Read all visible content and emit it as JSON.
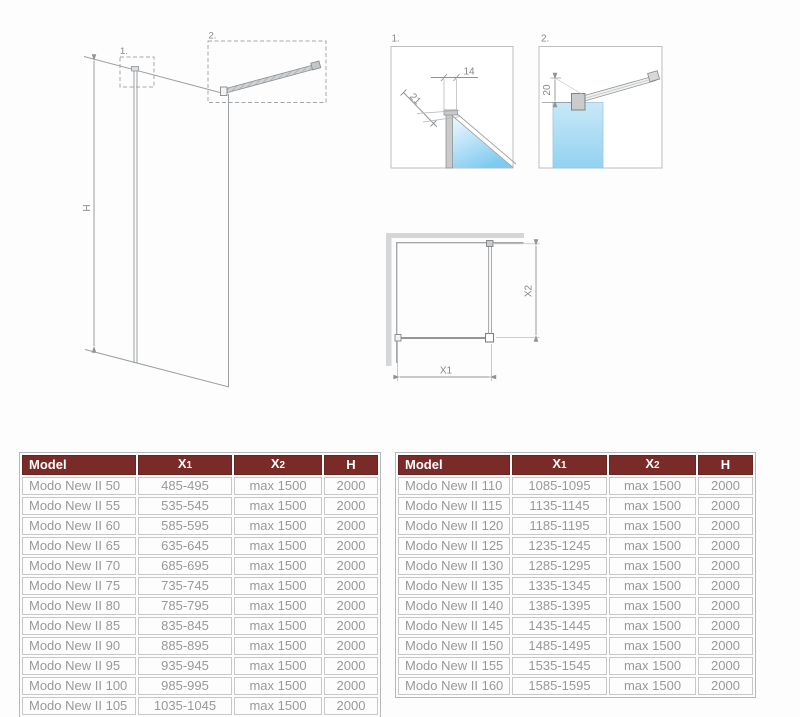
{
  "diagram": {
    "front_view": {
      "callout_1": "1.",
      "callout_2": "2.",
      "dim_h": "H"
    },
    "detail_1": {
      "label": "1.",
      "dim_14": "14",
      "dim_21": "21"
    },
    "detail_2": {
      "label": "2.",
      "dim_20": "20"
    },
    "top_view": {
      "dim_x1": "X1",
      "dim_x2": "X2"
    }
  },
  "tables": {
    "left": {
      "headers": [
        "Model",
        "X1",
        "X2",
        "H"
      ],
      "rows": [
        [
          "Modo New II 50",
          "485-495",
          "max 1500",
          "2000"
        ],
        [
          "Modo New II 55",
          "535-545",
          "max 1500",
          "2000"
        ],
        [
          "Modo New II 60",
          "585-595",
          "max 1500",
          "2000"
        ],
        [
          "Modo New II 65",
          "635-645",
          "max 1500",
          "2000"
        ],
        [
          "Modo New II 70",
          "685-695",
          "max 1500",
          "2000"
        ],
        [
          "Modo New II 75",
          "735-745",
          "max 1500",
          "2000"
        ],
        [
          "Modo New II 80",
          "785-795",
          "max 1500",
          "2000"
        ],
        [
          "Modo New II 85",
          "835-845",
          "max 1500",
          "2000"
        ],
        [
          "Modo New II 90",
          "885-895",
          "max 1500",
          "2000"
        ],
        [
          "Modo New II 95",
          "935-945",
          "max 1500",
          "2000"
        ],
        [
          "Modo New II 100",
          "985-995",
          "max 1500",
          "2000"
        ],
        [
          "Modo New II 105",
          "1035-1045",
          "max 1500",
          "2000"
        ]
      ]
    },
    "right": {
      "headers": [
        "Model",
        "X1",
        "X2",
        "H"
      ],
      "rows": [
        [
          "Modo New II 110",
          "1085-1095",
          "max 1500",
          "2000"
        ],
        [
          "Modo New II 115",
          "1135-1145",
          "max 1500",
          "2000"
        ],
        [
          "Modo New II 120",
          "1185-1195",
          "max 1500",
          "2000"
        ],
        [
          "Modo New II 125",
          "1235-1245",
          "max 1500",
          "2000"
        ],
        [
          "Modo New II 130",
          "1285-1295",
          "max 1500",
          "2000"
        ],
        [
          "Modo New II 135",
          "1335-1345",
          "max 1500",
          "2000"
        ],
        [
          "Modo New II 140",
          "1385-1395",
          "max 1500",
          "2000"
        ],
        [
          "Modo New II 145",
          "1435-1445",
          "max 1500",
          "2000"
        ],
        [
          "Modo New II 150",
          "1485-1495",
          "max 1500",
          "2000"
        ],
        [
          "Modo New II 155",
          "1535-1545",
          "max 1500",
          "2000"
        ],
        [
          "Modo New II 160",
          "1585-1595",
          "max 1500",
          "2000"
        ]
      ]
    }
  },
  "colors": {
    "header_bg": "#7a2b27",
    "header_text": "#ffffff",
    "row_text": "#97999b",
    "cell_border": "#c6c8ca",
    "line_gray": "#9aa0a4",
    "glass_blue": "#8fd0f0",
    "wall_gray": "#d4d6d7"
  }
}
